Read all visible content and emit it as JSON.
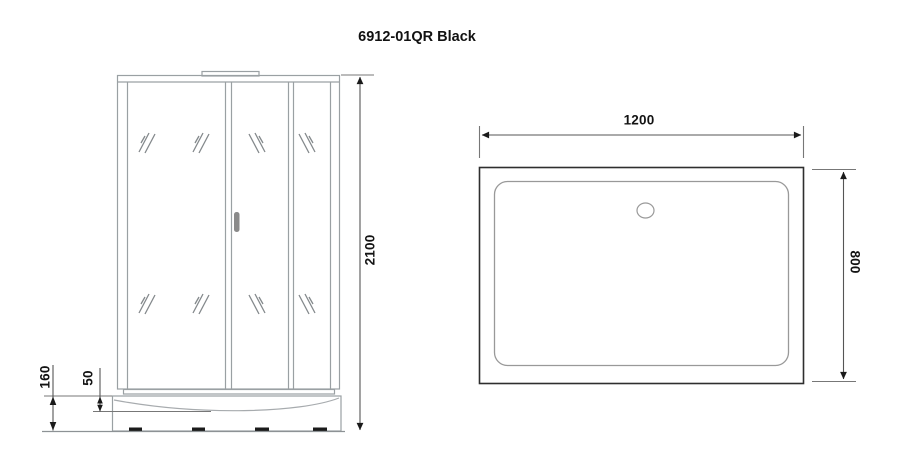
{
  "title": "6912-01QR Black",
  "views": {
    "front": {
      "name": "front-elevation",
      "dim_total_height": "2100",
      "dim_tray_height": "160",
      "dim_tray_lip": "50"
    },
    "top": {
      "name": "tray-top-view",
      "dim_width": "1200",
      "dim_depth": "800"
    }
  },
  "colors": {
    "frame_line": "#9aa0a3",
    "dark_line": "#2e2e2e",
    "dimension_line": "#555555",
    "text": "#131313"
  }
}
